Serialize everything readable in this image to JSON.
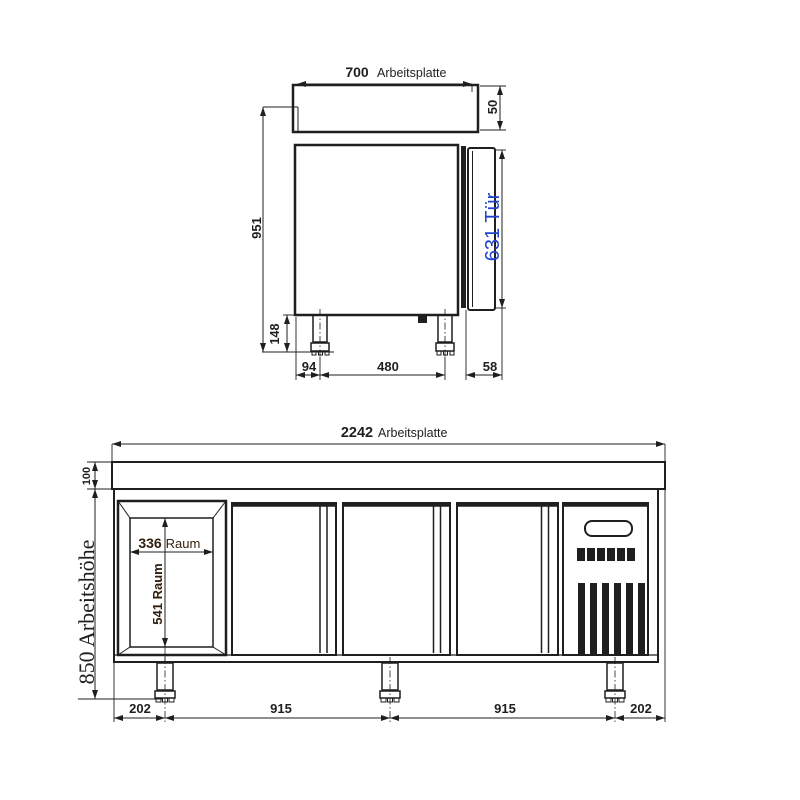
{
  "drawing": {
    "colors": {
      "ink": "#1f1f1f",
      "door_dim_blue": "#2144ce",
      "room_dim_brown": "#33200e",
      "background": "#ffffff"
    },
    "top_view": {
      "worktop_width_value": "700",
      "worktop_width_label": "Arbeitsplatte",
      "worktop_thickness": "50",
      "total_height": "951",
      "door_height": "631 Tür",
      "leg_height": "148",
      "front_leg_offset": "94",
      "leg_spacing": "480",
      "door_depth": "58"
    },
    "front_view": {
      "worktop_width_value": "2242",
      "worktop_width_label": "Arbeitsplatte",
      "worktop_band_height": "100",
      "working_height": "850 Arbeitshöhe",
      "compartment_width": "336",
      "compartment_width_label": "Raum",
      "compartment_height": "541 Raum",
      "bottom_dims": [
        "202",
        "915",
        "915",
        "202"
      ]
    }
  }
}
